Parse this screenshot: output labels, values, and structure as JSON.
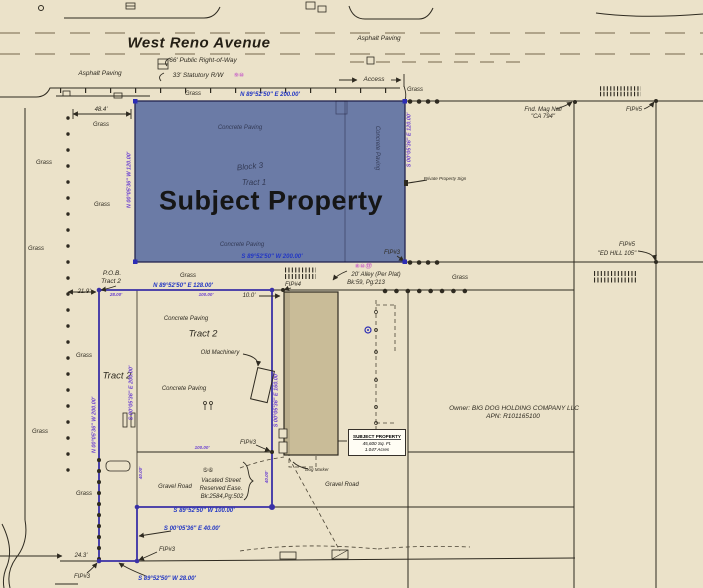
{
  "colors": {
    "parchment": "#ebe2c9",
    "line_dark": "#2e2a20",
    "boundary_purple": "#3a31a6",
    "bearing_blue": "#2337c4",
    "dim_purple": "#6a3fd0",
    "circled_magenta": "#c75fc7",
    "subject_fill": "#6b7ba6",
    "building_fill": "#c9bc98",
    "navy_label": "#333a55"
  },
  "info_box": {
    "title": "SUBJECT PROPERTY",
    "area_sqft": "45,600 Sq. Ft.",
    "area_acres": "1.047 Acres"
  },
  "labels": [
    {
      "n": "street-name",
      "t": "West Reno Avenue",
      "x": 199,
      "y": 43,
      "c": "street"
    },
    {
      "n": "asphalt-paving-label-1",
      "t": "Asphalt Paving",
      "x": 100,
      "y": 74,
      "c": "s65"
    },
    {
      "n": "asphalt-paving-label-2",
      "t": "Asphalt Paving",
      "x": 379,
      "y": 39,
      "c": "s65"
    },
    {
      "n": "right-of-way-label",
      "t": "66' Public Right-of-Way",
      "x": 203,
      "y": 61,
      "c": "s65"
    },
    {
      "n": "statutory-rw-label",
      "t": "33' Statutory R/W",
      "x": 198,
      "y": 76,
      "c": "s65"
    },
    {
      "n": "statutory-rw-note-refs",
      "t": "⑨⑩",
      "x": 239,
      "y": 76,
      "c": "s6 magenta"
    },
    {
      "n": "access-label",
      "t": "Access",
      "x": 374,
      "y": 80,
      "c": "s65"
    },
    {
      "n": "grass-label-1",
      "t": "Grass",
      "x": 193,
      "y": 94,
      "c": "s6"
    },
    {
      "n": "grass-label-2",
      "t": "Grass",
      "x": 415,
      "y": 90,
      "c": "s6"
    },
    {
      "n": "bearing-north-subject",
      "t": "N 89°52'50\" E 200.00'",
      "x": 270,
      "y": 95,
      "c": "s6 blue"
    },
    {
      "n": "fnd-mag-nail-label-1",
      "t": "Fnd. Mag Nail",
      "x": 543,
      "y": 110,
      "c": "s6"
    },
    {
      "n": "fnd-mag-nail-label-2",
      "t": "\"CA 794\"",
      "x": 543,
      "y": 117,
      "c": "s6"
    },
    {
      "n": "fip5-north-label",
      "t": "FIP#5",
      "x": 634,
      "y": 110,
      "c": "s6"
    },
    {
      "n": "dim-48-4",
      "t": "48.4'",
      "x": 101,
      "y": 110,
      "c": "s6"
    },
    {
      "n": "grass-label-3",
      "t": "Grass",
      "x": 101,
      "y": 125,
      "c": "s6"
    },
    {
      "n": "grass-label-4",
      "t": "Grass",
      "x": 44,
      "y": 163,
      "c": "s6"
    },
    {
      "n": "grass-label-5",
      "t": "Grass",
      "x": 102,
      "y": 205,
      "c": "s6"
    },
    {
      "n": "grass-label-6",
      "t": "Grass",
      "x": 36,
      "y": 249,
      "c": "s6"
    },
    {
      "n": "concrete-paving-subject-top",
      "t": "Concrete Paving",
      "x": 240,
      "y": 128,
      "c": "s6 navy"
    },
    {
      "n": "block-3-label",
      "t": "Block 3",
      "x": 250,
      "y": 167,
      "c": "s8 navy",
      "r": -6
    },
    {
      "n": "tract-1-label",
      "t": "Tract 1",
      "x": 254,
      "y": 183,
      "c": "s8 navy"
    },
    {
      "n": "subject-property-title",
      "t": "Subject Property",
      "x": 271,
      "y": 201,
      "c": "big"
    },
    {
      "n": "concrete-paving-subject-bottom",
      "t": "Concrete Paving",
      "x": 242,
      "y": 245,
      "c": "s6 navy"
    },
    {
      "n": "concrete-paving-subject-right",
      "t": "Concrete Paving",
      "x": 377,
      "y": 148,
      "c": "s6 navy",
      "r": 90
    },
    {
      "n": "bearing-west-subject",
      "t": "N 00°05'36\" W 120.00'",
      "x": 130,
      "y": 180,
      "c": "s55 purple",
      "r": -90
    },
    {
      "n": "bearing-east-subject",
      "t": "S 00°05'36\" E 120.00'",
      "x": 410,
      "y": 140,
      "c": "s55 purple",
      "r": -90
    },
    {
      "n": "bearing-south-subject",
      "t": "S 89°52'50\" W 200.00'",
      "x": 272,
      "y": 257,
      "c": "s6 blue"
    },
    {
      "n": "fip3-subject-se-label",
      "t": "FIP#3",
      "x": 392,
      "y": 253,
      "c": "s6"
    },
    {
      "n": "private-property-sign-label",
      "t": "Private Property Sign",
      "x": 445,
      "y": 179,
      "c": "s45"
    },
    {
      "n": "alley-note-refs",
      "t": "⑧⑩⑬",
      "x": 363,
      "y": 267,
      "c": "s6 magenta"
    },
    {
      "n": "alley-label",
      "t": "20' Alley (Per Plat)",
      "x": 376,
      "y": 275,
      "c": "s6"
    },
    {
      "n": "alley-book-label",
      "t": "Bk:59, Pg:213",
      "x": 366,
      "y": 283,
      "c": "s6"
    },
    {
      "n": "grass-label-7",
      "t": "Grass",
      "x": 188,
      "y": 276,
      "c": "s6"
    },
    {
      "n": "grass-label-8",
      "t": "Grass",
      "x": 460,
      "y": 278,
      "c": "s6"
    },
    {
      "n": "fip5-edhill-label-1",
      "t": "FIP#5",
      "x": 627,
      "y": 245,
      "c": "s6"
    },
    {
      "n": "fip5-edhill-label-2",
      "t": "\"ED HILL 105\"",
      "x": 617,
      "y": 254,
      "c": "s6"
    },
    {
      "n": "pob-label-1",
      "t": "P.O.B.",
      "x": 112,
      "y": 274,
      "c": "s65"
    },
    {
      "n": "pob-label-2",
      "t": "Tract 2",
      "x": 111,
      "y": 282,
      "c": "s65"
    },
    {
      "n": "dim-21-9",
      "t": "21.9'",
      "x": 84,
      "y": 292,
      "c": "s6"
    },
    {
      "n": "bearing-north-tract2",
      "t": "N 89°52'50\" E 128.00'",
      "x": 183,
      "y": 286,
      "c": "s6 blue"
    },
    {
      "n": "dim-28",
      "t": "28.00'",
      "x": 116,
      "y": 295,
      "c": "s45 purple"
    },
    {
      "n": "dim-100-north",
      "t": "100.00'",
      "x": 206,
      "y": 295,
      "c": "s45 purple"
    },
    {
      "n": "dim-10",
      "t": "10.0'",
      "x": 249,
      "y": 296,
      "c": "s6"
    },
    {
      "n": "fip4-label",
      "t": "FIP#4",
      "x": 293,
      "y": 285,
      "c": "s6"
    },
    {
      "n": "concrete-paving-tract2-1",
      "t": "Concrete Paving",
      "x": 186,
      "y": 319,
      "c": "s6"
    },
    {
      "n": "tract2-label-main",
      "t": "Tract 2",
      "x": 203,
      "y": 334,
      "c": "s9"
    },
    {
      "n": "old-machinery-label",
      "t": "Old Machinery",
      "x": 220,
      "y": 353,
      "c": "s6"
    },
    {
      "n": "tract2-label-west",
      "t": "Tract 2",
      "x": 117,
      "y": 376,
      "c": "s9"
    },
    {
      "n": "concrete-paving-tract2-2",
      "t": "Concrete Paving",
      "x": 184,
      "y": 389,
      "c": "s6"
    },
    {
      "n": "grass-label-9",
      "t": "Grass",
      "x": 84,
      "y": 356,
      "c": "s6"
    },
    {
      "n": "grass-label-10",
      "t": "Grass",
      "x": 40,
      "y": 432,
      "c": "s6"
    },
    {
      "n": "bearing-west-tract2",
      "t": "N 00°05'36\" W 200.00'",
      "x": 95,
      "y": 425,
      "c": "s55 purple",
      "r": -90
    },
    {
      "n": "bearing-west-tract2-record",
      "t": "S 00°05'36\" E 200.00'",
      "x": 132,
      "y": 393,
      "c": "s55 purple",
      "r": -90
    },
    {
      "n": "bearing-east-tract2",
      "t": "S 00°05'36\" E 160.00'",
      "x": 277,
      "y": 400,
      "c": "s55 purple",
      "r": -90
    },
    {
      "n": "fip3-mid-label",
      "t": "FIP#3",
      "x": 248,
      "y": 443,
      "c": "s6"
    },
    {
      "n": "dim-100-south",
      "t": "100.00'",
      "x": 202,
      "y": 448,
      "c": "s45 purple"
    },
    {
      "n": "vacated-note-refs",
      "t": "⑤⑥",
      "x": 208,
      "y": 471,
      "c": "s6"
    },
    {
      "n": "vacated-label-1",
      "t": "Vacated Street",
      "x": 221,
      "y": 481,
      "c": "s6"
    },
    {
      "n": "vacated-label-2",
      "t": "Reserved Ease.",
      "x": 221,
      "y": 489,
      "c": "s6"
    },
    {
      "n": "vacated-label-3",
      "t": "Bk:2584,Pg:502",
      "x": 222,
      "y": 497,
      "c": "s6"
    },
    {
      "n": "dim-40-west",
      "t": "40.00'",
      "x": 141,
      "y": 473,
      "c": "s45 purple",
      "r": -90
    },
    {
      "n": "dim-40-east",
      "t": "40.00'",
      "x": 267,
      "y": 477,
      "c": "s45 purple",
      "r": -90
    },
    {
      "n": "gravel-road-label-1",
      "t": "Gravel Road",
      "x": 175,
      "y": 487,
      "c": "s6"
    },
    {
      "n": "gravel-road-label-2",
      "t": "Gravel Road",
      "x": 342,
      "y": 485,
      "c": "s6"
    },
    {
      "n": "grass-label-11",
      "t": "Grass",
      "x": 84,
      "y": 494,
      "c": "s6"
    },
    {
      "n": "bearing-south-tract2",
      "t": "S 89°52'50\" W 100.00'",
      "x": 204,
      "y": 511,
      "c": "s6 blue"
    },
    {
      "n": "bearing-east-jog",
      "t": "S 00°05'36\" E 40.00'",
      "x": 192,
      "y": 529,
      "c": "s6 blue"
    },
    {
      "n": "fip3-jog-label",
      "t": "FIP#3",
      "x": 167,
      "y": 550,
      "c": "s6"
    },
    {
      "n": "dim-24-3",
      "t": "24.3'",
      "x": 81,
      "y": 556,
      "c": "s6"
    },
    {
      "n": "fip3-sw-label",
      "t": "FIP#3",
      "x": 82,
      "y": 577,
      "c": "s6"
    },
    {
      "n": "bearing-south-jog",
      "t": "S 89°52'50\" W 28.00'",
      "x": 167,
      "y": 579,
      "c": "s6 blue"
    },
    {
      "n": "dog-marker-label",
      "t": "Dog Marker",
      "x": 317,
      "y": 470,
      "c": "s45"
    },
    {
      "n": "owner-label-1",
      "t": "Owner: BIG DOG HOLDING COMPANY LLC",
      "x": 514,
      "y": 409,
      "c": "s65"
    },
    {
      "n": "owner-label-2",
      "t": "APN: R101165100",
      "x": 513,
      "y": 417,
      "c": "s65"
    }
  ]
}
